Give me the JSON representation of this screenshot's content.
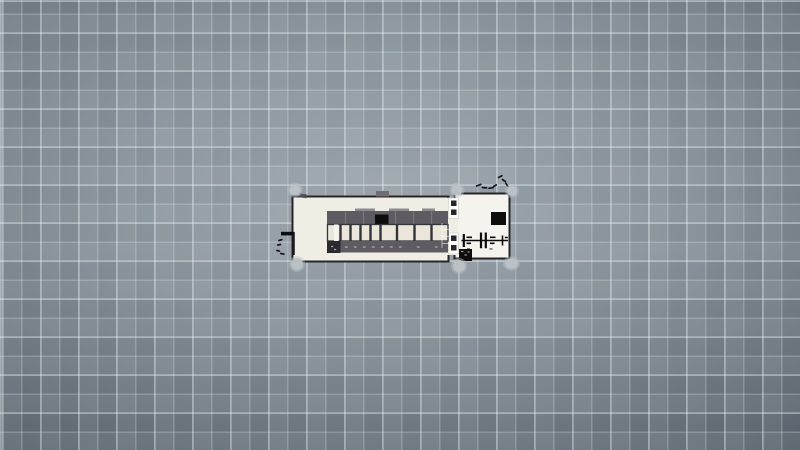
{
  "scene": {
    "description": "top-down floor plan of a small two-room building centered on a gray plaid grid ground; no visible text",
    "objects": {
      "rooms": 2,
      "corner_pillars": 6,
      "table_cells": 9,
      "wall_panels": 2,
      "black_square_fixtures": 3,
      "door_mark_clusters": 2
    }
  },
  "colors": {
    "groundHi": "#9aa3a8",
    "groundMid": "#87929a",
    "groundLo": "#657079",
    "gridLine": "rgba(228,240,246,0.26)",
    "gridBright": "rgba(238,248,252,0.18)",
    "gridSoft": "rgba(255,255,255,0.05)",
    "floorLeft": "#f0ede5",
    "floorRight": "#f5f3ed",
    "wall": "#26262a",
    "bandDark": "#5f5b62",
    "bandCap": "#8d8a91",
    "bandBlock": "#2c2a2e",
    "cellFill": "#eae6d9",
    "cellDivider": "#34343b",
    "blackFixture": "#0d0d0d",
    "pillar": "#bcc2c6",
    "pillarHalo": "rgba(188,196,201,0.45)",
    "doorTab": "#6e6e73",
    "panelFill": "#fcfcf9",
    "panelEdge": "#d8d5cc",
    "panelDot": "#26262e",
    "aisle": "#f6f4ee",
    "mark": "#17171c"
  }
}
